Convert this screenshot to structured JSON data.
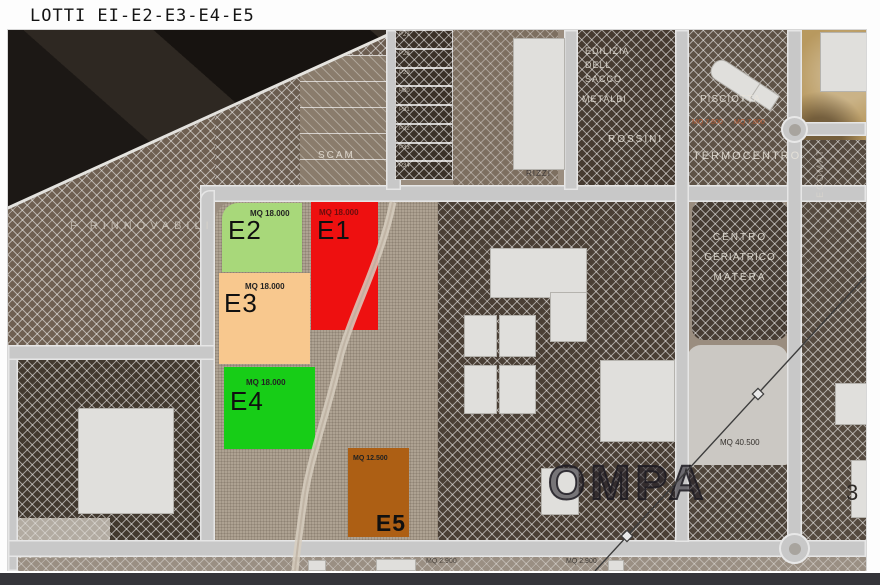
{
  "title": "LOTTI EI-E2-E3-E4-E5",
  "lots": [
    {
      "id": "E1",
      "area": "MQ 18.000",
      "color": "#ee1010"
    },
    {
      "id": "E2",
      "area": "MQ 18.000",
      "color": "#a8d87a"
    },
    {
      "id": "E3",
      "area": "MQ 18.000",
      "color": "#f8c88e"
    },
    {
      "id": "E4",
      "area": "MQ 18.000",
      "color": "#17cd17"
    },
    {
      "id": "E5",
      "area": "MQ 12.500",
      "color": "#ad5f14"
    }
  ],
  "labels": {
    "scam": "SCAM",
    "f_rinnovabili": "F RINNOVABILI",
    "rizzi": "RIZZI",
    "edilizia_1": "EDILIZIA",
    "edilizia_2": "DELL",
    "edilizia_3": "SACCO",
    "metalbi": "METALBI",
    "rossini": "ROSSINI",
    "pisciotta": "PISCIOTTA",
    "mq_7800_a": "MQ 7.800",
    "mq_7800_b": "MQ 7.800",
    "termocentro": "TERMOCENTRO",
    "centro_1": "CENTRO",
    "centro_2": "GERIATRICO",
    "centro_3": "MATERA",
    "ecomat": "ECOMAT",
    "mq_40500": "MQ 40.500",
    "ompa": "OMPA",
    "right_3": "3",
    "mq_2900_a": "MQ 2.900",
    "mq_2900_b": "MQ 2.900"
  },
  "p_lots": [
    "P27",
    "P28",
    "P29",
    "P30",
    "P31",
    "P32",
    "P33",
    "P34"
  ]
}
